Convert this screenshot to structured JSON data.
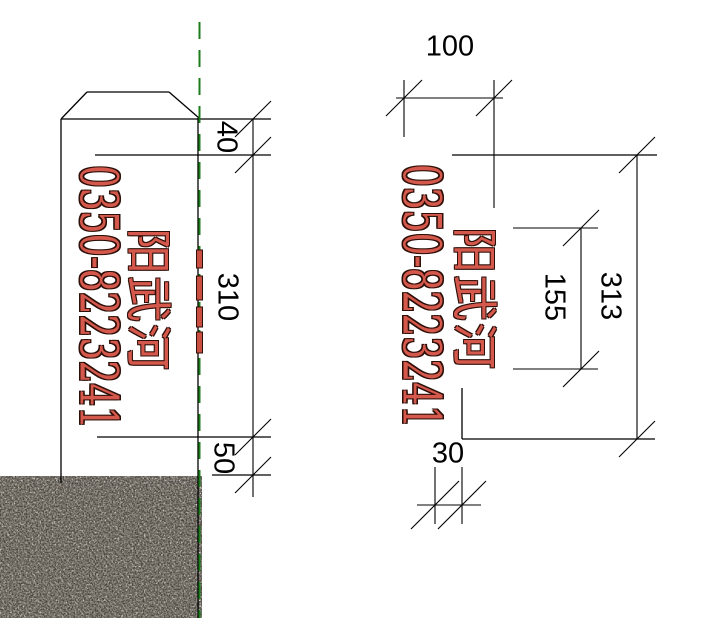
{
  "page": {
    "background": "#ffffff",
    "description": "CAD technical drawing of an inscribed marker post, side elevation with ground hatch and front face elevation with dimensions"
  },
  "side_view": {
    "phone_number": "0350-8223241",
    "river_name": "阳武河",
    "dims": {
      "top": "40",
      "middle": "310",
      "bottom": "50"
    }
  },
  "front_view": {
    "phone_number": "0350-8223241",
    "river_name": "阳武河",
    "dims": {
      "width": "100",
      "inner_height": "155",
      "total_height": "313",
      "bottom_inset": "30"
    }
  },
  "colors": {
    "line": "#000000",
    "centerline_green": "#1c7c1c",
    "inscription_fill": "#d4584c",
    "inscription_outline": "#2d0f08",
    "ground_base": "#d8d1c5",
    "ground_speckle_dark": "#4a453e",
    "ground_speckle_mid": "#8a857c"
  }
}
